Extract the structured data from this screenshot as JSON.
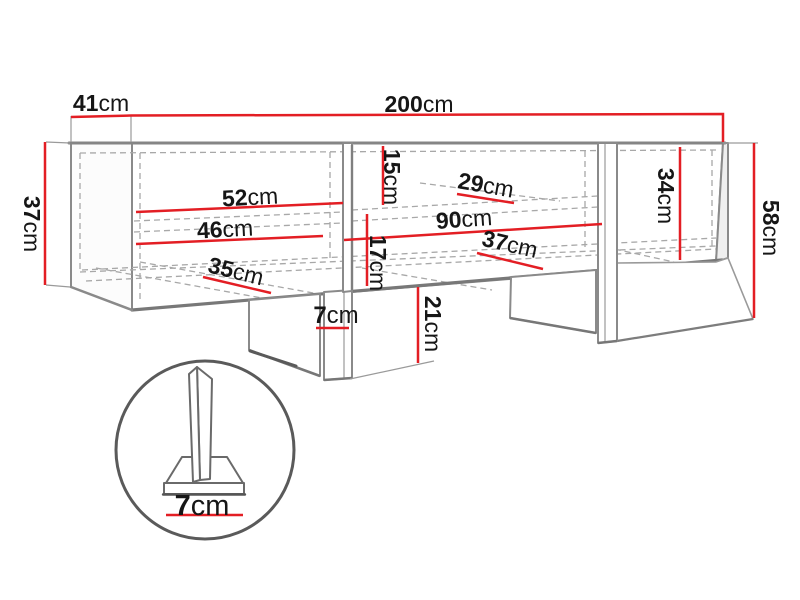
{
  "diagram": {
    "type": "furniture-dimension-drawing",
    "subject": "wall-mounted TV cabinet with leg detail callout",
    "unit": "cm",
    "colors": {
      "dimension_line": "#e31e24",
      "outline": "#8a8a8a",
      "outline_dark": "#777777",
      "hidden_edge": "#a8a8a8",
      "callout": "#5a5a5a",
      "text": "#161616",
      "background": "#ffffff"
    },
    "dimensions": [
      {
        "id": "depth-top",
        "number": "41",
        "unit": "cm",
        "label_text": "41cm",
        "points": [
          [
            71,
            117
          ],
          [
            131,
            115.5
          ]
        ],
        "label": {
          "x": 101,
          "y": 103,
          "rotate": 0,
          "size": 23
        }
      },
      {
        "id": "width-total",
        "number": "200",
        "unit": "cm",
        "label_text": "200cm",
        "points": [
          [
            131,
            115.5
          ],
          [
            723,
            114
          ],
          [
            723,
            142
          ]
        ],
        "label": {
          "x": 419,
          "y": 104,
          "rotate": 0,
          "size": 23
        }
      },
      {
        "id": "height-left",
        "number": "37",
        "unit": "cm",
        "label_text": "37cm",
        "points": [
          [
            45,
            142
          ],
          [
            45,
            285
          ]
        ],
        "label": {
          "x": 32,
          "y": 224,
          "rotate": 90,
          "size": 23
        }
      },
      {
        "id": "height-total-right",
        "number": "58",
        "unit": "cm",
        "label_text": "58cm",
        "points": [
          [
            754,
            143
          ],
          [
            754,
            318
          ]
        ],
        "label": {
          "x": 771,
          "y": 228,
          "rotate": 90,
          "size": 23
        }
      },
      {
        "id": "left-shelf-upper-width",
        "number": "52",
        "unit": "cm",
        "label_text": "52cm",
        "points": [
          [
            136,
            212
          ],
          [
            343,
            203
          ]
        ],
        "label": {
          "x": 250,
          "y": 197,
          "rotate": -3,
          "size": 23
        }
      },
      {
        "id": "left-shelf-lower-width",
        "number": "46",
        "unit": "cm",
        "label_text": "46cm",
        "points": [
          [
            136,
            244
          ],
          [
            323,
            236
          ]
        ],
        "label": {
          "x": 225,
          "y": 229,
          "rotate": -3,
          "size": 23
        }
      },
      {
        "id": "left-depth",
        "number": "35",
        "unit": "cm",
        "label_text": "35cm",
        "points": [
          [
            203,
            277
          ],
          [
            271,
            293
          ]
        ],
        "label": {
          "x": 236,
          "y": 271,
          "rotate": 14,
          "size": 23
        }
      },
      {
        "id": "middle-upper-gap",
        "number": "15",
        "unit": "cm",
        "label_text": "15cm",
        "points": [
          [
            383,
            146
          ],
          [
            383,
            205
          ]
        ],
        "label": {
          "x": 392,
          "y": 177,
          "rotate": 90,
          "size": 23
        }
      },
      {
        "id": "middle-shelf-depth",
        "number": "29",
        "unit": "cm",
        "label_text": "29cm",
        "points": [
          [
            457,
            194
          ],
          [
            514,
            203
          ]
        ],
        "label": {
          "x": 486,
          "y": 185,
          "rotate": 10,
          "size": 23
        }
      },
      {
        "id": "middle-width",
        "number": "90",
        "unit": "cm",
        "label_text": "90cm",
        "points": [
          [
            344,
            240
          ],
          [
            602,
            224
          ]
        ],
        "label": {
          "x": 464,
          "y": 219,
          "rotate": -4,
          "size": 23
        }
      },
      {
        "id": "middle-lower-gap",
        "number": "17",
        "unit": "cm",
        "label_text": "17cm",
        "points": [
          [
            367,
            214
          ],
          [
            367,
            286
          ]
        ],
        "label": {
          "x": 378,
          "y": 263,
          "rotate": 90,
          "size": 23
        }
      },
      {
        "id": "middle-depth",
        "number": "37",
        "unit": "cm",
        "label_text": "37cm",
        "points": [
          [
            477,
            253
          ],
          [
            543,
            269
          ]
        ],
        "label": {
          "x": 510,
          "y": 244,
          "rotate": 13,
          "size": 23
        }
      },
      {
        "id": "leg-width",
        "number": "7",
        "unit": "cm",
        "label_text": "7cm",
        "points": [
          [
            316,
            328
          ],
          [
            349,
            328
          ]
        ],
        "label": {
          "x": 336,
          "y": 315,
          "rotate": 0,
          "size": 24
        }
      },
      {
        "id": "leg-height",
        "number": "21",
        "unit": "cm",
        "label_text": "21cm",
        "points": [
          [
            418,
            287
          ],
          [
            418,
            363
          ]
        ],
        "label": {
          "x": 433,
          "y": 324,
          "rotate": 90,
          "size": 23
        }
      },
      {
        "id": "right-inner-height",
        "number": "34",
        "unit": "cm",
        "label_text": "34cm",
        "points": [
          [
            680,
            147
          ],
          [
            680,
            260
          ]
        ],
        "label": {
          "x": 666,
          "y": 196,
          "rotate": 90,
          "size": 23
        }
      },
      {
        "id": "leg-detail-base-width",
        "number": "7",
        "unit": "cm",
        "label_text": "7cm",
        "points": [
          [
            166,
            515
          ],
          [
            243,
            515
          ]
        ],
        "label": {
          "x": 202,
          "y": 506,
          "rotate": 0,
          "size": 29
        }
      }
    ]
  }
}
